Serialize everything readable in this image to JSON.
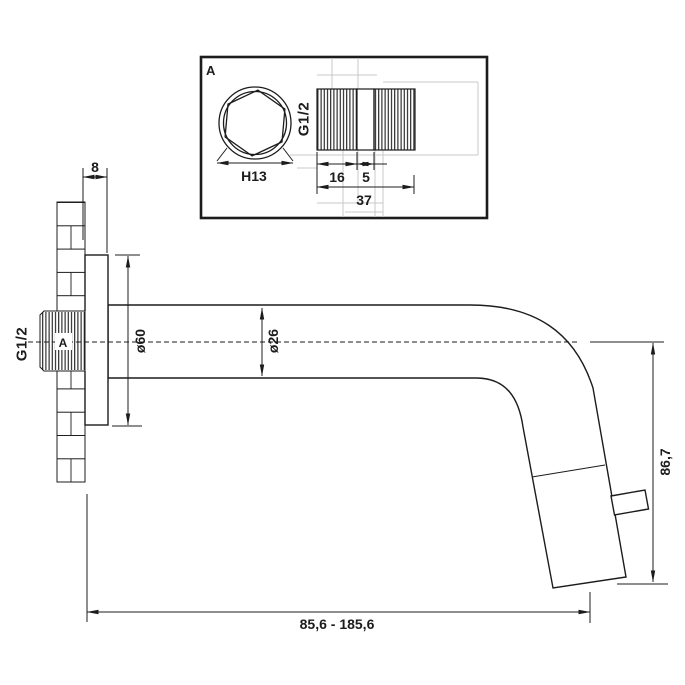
{
  "colors": {
    "line": "#1c1c1c",
    "construction_line": "#c9c9c9",
    "background": "#ffffff"
  },
  "detail_view": {
    "marker": "A",
    "hex_width": "H13",
    "thread_size": "G1/2",
    "thread_length": "16",
    "shoulder_length": "5",
    "total_length": "37"
  },
  "main_view": {
    "thread_size": "G1/2",
    "detail_marker": "A",
    "flange_offset": "8",
    "flange_diameter": "ø60",
    "spout_diameter": "ø26",
    "outlet_height": "86,7",
    "spout_length_range": "85,6 - 185,6"
  }
}
